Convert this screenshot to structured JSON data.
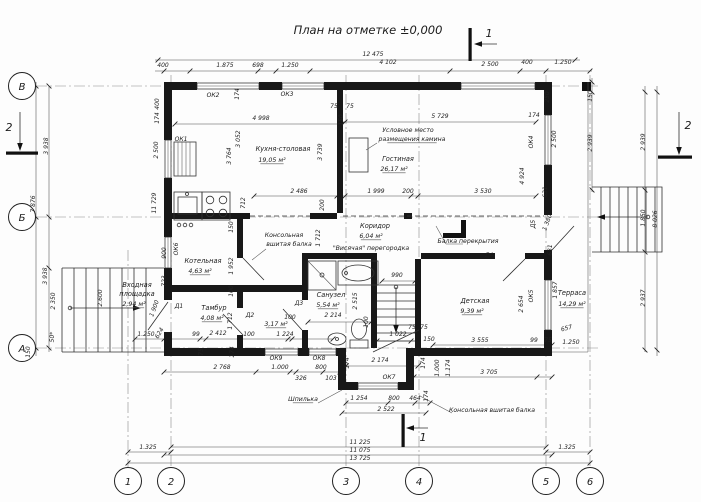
{
  "title": "План на отметке ±0,000",
  "axes": {
    "bottom": [
      {
        "label": "1",
        "x": 128
      },
      {
        "label": "2",
        "x": 171
      },
      {
        "label": "3",
        "x": 346
      },
      {
        "label": "4",
        "x": 419
      },
      {
        "label": "5",
        "x": 546
      },
      {
        "label": "6",
        "x": 590
      }
    ],
    "left": [
      {
        "label": "В",
        "y": 86
      },
      {
        "label": "Б",
        "y": 217
      },
      {
        "label": "А",
        "y": 348
      }
    ]
  },
  "section_markers": {
    "top": "1",
    "bottom": "1",
    "left": "2",
    "right": "2"
  },
  "rooms": [
    {
      "name": "Кухня-столовая",
      "area": "19,05 м²",
      "name_xy": [
        283,
        151
      ],
      "area_xy": [
        272,
        162
      ]
    },
    {
      "name": "Гостиная",
      "area": "26,17 м²",
      "name_xy": [
        398,
        161
      ],
      "area_xy": [
        394,
        171
      ]
    },
    {
      "name": "Коридор",
      "area": "6,04 м²",
      "name_xy": [
        375,
        228
      ],
      "area_xy": [
        371,
        238
      ]
    },
    {
      "name": "Санузел",
      "area": "5,54 м²",
      "name_xy": [
        331,
        297
      ],
      "area_xy": [
        328,
        307
      ]
    },
    {
      "name": "",
      "area": "3,17 м²",
      "name_xy": [
        276,
        318
      ],
      "area_xy": [
        276,
        326
      ]
    },
    {
      "name": "Котельная",
      "area": "4,63 м²",
      "name_xy": [
        203,
        263
      ],
      "area_xy": [
        200,
        273
      ]
    },
    {
      "name": "Тамбур",
      "area": "4,08 м²",
      "name_xy": [
        214,
        310
      ],
      "area_xy": [
        212,
        320
      ]
    },
    {
      "name": "Детская",
      "area": "9,39 м²",
      "name_xy": [
        475,
        303
      ],
      "area_xy": [
        472,
        313
      ]
    },
    {
      "name": "Терраса",
      "area": "14,29 м²",
      "name_xy": [
        572,
        295
      ],
      "area_xy": [
        572,
        306
      ]
    },
    {
      "name": "Входная площадка",
      "name_lines": [
        "Входная",
        "площадка"
      ],
      "area": "2,94 м²",
      "name_xy": [
        137,
        287
      ],
      "area_xy": [
        134,
        306
      ]
    }
  ],
  "annotations": [
    {
      "t": "Условное место",
      "x": 408,
      "y": 132
    },
    {
      "t": "размещения камина",
      "x": 412,
      "y": 141,
      "u": 1
    },
    {
      "t": "Балка перекрытия",
      "x": 468,
      "y": 243
    },
    {
      "t": "\"Висячая\" перегородка",
      "x": 371,
      "y": 250
    },
    {
      "t": "Консольная",
      "x": 284,
      "y": 237
    },
    {
      "t": "вшитая балка",
      "x": 289,
      "y": 246
    },
    {
      "t": "Консольная вшитая балка",
      "x": 492,
      "y": 412
    },
    {
      "t": "Шпилька",
      "x": 303,
      "y": 401,
      "u": 1
    }
  ],
  "window_marks": [
    {
      "t": "ОК1",
      "x": 181,
      "y": 141
    },
    {
      "t": "ОК2",
      "x": 213,
      "y": 97
    },
    {
      "t": "ОК3",
      "x": 287,
      "y": 96
    },
    {
      "t": "ОК4",
      "x": 533,
      "y": 142,
      "r": -90
    },
    {
      "t": "ОК5",
      "x": 533,
      "y": 296,
      "r": -90
    },
    {
      "t": "ОК6",
      "x": 178,
      "y": 249,
      "r": -90
    },
    {
      "t": "ОК7",
      "x": 389,
      "y": 379
    },
    {
      "t": "ОК8",
      "x": 319,
      "y": 360
    },
    {
      "t": "ОК9",
      "x": 276,
      "y": 360
    }
  ],
  "door_marks": [
    {
      "t": "Д1",
      "x": 179,
      "y": 308
    },
    {
      "t": "Д2",
      "x": 250,
      "y": 317
    },
    {
      "t": "Д3",
      "x": 299,
      "y": 305
    },
    {
      "t": "Д4",
      "x": 489,
      "y": 257
    },
    {
      "t": "Д5",
      "x": 535,
      "y": 224,
      "r": -90
    }
  ],
  "dimensions": [
    {
      "t": "12 475",
      "x": 373,
      "y": 56
    },
    {
      "t": "400",
      "x": 163,
      "y": 67
    },
    {
      "t": "1.875",
      "x": 225,
      "y": 67
    },
    {
      "t": "698",
      "x": 258,
      "y": 67
    },
    {
      "t": "1.250",
      "x": 290,
      "y": 67
    },
    {
      "t": "4 102",
      "x": 388,
      "y": 64
    },
    {
      "t": "2 500",
      "x": 490,
      "y": 66
    },
    {
      "t": "400",
      "x": 527,
      "y": 64
    },
    {
      "t": "1.250",
      "x": 563,
      "y": 64
    },
    {
      "t": "400",
      "x": 159,
      "y": 104,
      "r": -90
    },
    {
      "t": "174",
      "x": 159,
      "y": 118,
      "r": -90
    },
    {
      "t": "2 500",
      "x": 158,
      "y": 150,
      "r": -90
    },
    {
      "t": "11 729",
      "x": 156,
      "y": 203,
      "r": -90
    },
    {
      "t": "174",
      "x": 239,
      "y": 94,
      "r": -90
    },
    {
      "t": "4 998",
      "x": 261,
      "y": 120
    },
    {
      "t": "3 052",
      "x": 240,
      "y": 139,
      "r": -90
    },
    {
      "t": "3 764",
      "x": 231,
      "y": 156,
      "r": -90
    },
    {
      "t": "3 739",
      "x": 322,
      "y": 152,
      "r": -90
    },
    {
      "t": "2 486",
      "x": 299,
      "y": 193
    },
    {
      "t": "200",
      "x": 324,
      "y": 205,
      "r": -90
    },
    {
      "t": "712",
      "x": 245,
      "y": 203,
      "r": -90
    },
    {
      "t": "150",
      "x": 233,
      "y": 227,
      "r": -90
    },
    {
      "t": "75",
      "x": 334,
      "y": 108
    },
    {
      "t": "75",
      "x": 350,
      "y": 108
    },
    {
      "t": "150",
      "x": 343,
      "y": 120,
      "r": -90
    },
    {
      "t": "5 729",
      "x": 440,
      "y": 118
    },
    {
      "t": "174",
      "x": 534,
      "y": 117
    },
    {
      "t": "1 999",
      "x": 376,
      "y": 193
    },
    {
      "t": "200",
      "x": 408,
      "y": 193
    },
    {
      "t": "3 530",
      "x": 483,
      "y": 193
    },
    {
      "t": "4 924",
      "x": 524,
      "y": 176,
      "r": -90
    },
    {
      "t": "250",
      "x": 549,
      "y": 97,
      "r": -90
    },
    {
      "t": "2 500",
      "x": 556,
      "y": 139,
      "r": -90
    },
    {
      "t": "631",
      "x": 547,
      "y": 192,
      "r": -90
    },
    {
      "t": "150",
      "x": 592,
      "y": 96,
      "r": -90
    },
    {
      "t": "2 939",
      "x": 592,
      "y": 143,
      "r": -90
    },
    {
      "t": "2 939",
      "x": 645,
      "y": 142,
      "r": -90
    },
    {
      "t": "1.850",
      "x": 645,
      "y": 218,
      "r": -90
    },
    {
      "t": "2 937",
      "x": 645,
      "y": 298,
      "r": -90
    },
    {
      "t": "8 026",
      "x": 657,
      "y": 219,
      "r": -90
    },
    {
      "t": "1 380",
      "x": 549,
      "y": 223,
      "r": -70
    },
    {
      "t": "631",
      "x": 552,
      "y": 250,
      "r": -90
    },
    {
      "t": "2 654",
      "x": 523,
      "y": 304,
      "r": -90
    },
    {
      "t": "1 857",
      "x": 557,
      "y": 290,
      "r": -90
    },
    {
      "t": "657",
      "x": 567,
      "y": 330,
      "r": -15
    },
    {
      "t": "99",
      "x": 534,
      "y": 342
    },
    {
      "t": "75",
      "x": 548,
      "y": 342
    },
    {
      "t": "1.250",
      "x": 571,
      "y": 344
    },
    {
      "t": "3 938",
      "x": 48,
      "y": 146,
      "r": -90
    },
    {
      "t": "7 876",
      "x": 35,
      "y": 204,
      "r": -90
    },
    {
      "t": "3 938",
      "x": 47,
      "y": 276,
      "r": -90
    },
    {
      "t": "2 350",
      "x": 55,
      "y": 301,
      "r": -90
    },
    {
      "t": "2.600",
      "x": 102,
      "y": 298,
      "r": -90
    },
    {
      "t": "50*",
      "x": 54,
      "y": 337,
      "r": -90
    },
    {
      "t": "150",
      "x": 30,
      "y": 352,
      "r": -90
    },
    {
      "t": "900",
      "x": 166,
      "y": 253,
      "r": -90
    },
    {
      "t": "723",
      "x": 166,
      "y": 281,
      "r": -90
    },
    {
      "t": "1 900",
      "x": 156,
      "y": 309,
      "r": -70
    },
    {
      "t": "1 952",
      "x": 233,
      "y": 266,
      "r": -90
    },
    {
      "t": "100",
      "x": 233,
      "y": 291,
      "r": -90
    },
    {
      "t": "1 712",
      "x": 232,
      "y": 321,
      "r": -90
    },
    {
      "t": "1 712",
      "x": 320,
      "y": 238,
      "r": -90
    },
    {
      "t": "1.250",
      "x": 146,
      "y": 336
    },
    {
      "t": "624",
      "x": 161,
      "y": 334,
      "r": -60
    },
    {
      "t": "99",
      "x": 196,
      "y": 336
    },
    {
      "t": "2 412",
      "x": 218,
      "y": 335
    },
    {
      "t": "100",
      "x": 249,
      "y": 336
    },
    {
      "t": "1 224",
      "x": 285,
      "y": 336
    },
    {
      "t": "75",
      "x": 203,
      "y": 352,
      "r": -90
    },
    {
      "t": "174",
      "x": 234,
      "y": 352,
      "r": -90
    },
    {
      "t": "2 768",
      "x": 222,
      "y": 369
    },
    {
      "t": "1.000",
      "x": 280,
      "y": 369
    },
    {
      "t": "326",
      "x": 301,
      "y": 380
    },
    {
      "t": "800",
      "x": 321,
      "y": 369
    },
    {
      "t": "103",
      "x": 331,
      "y": 380
    },
    {
      "t": "174",
      "x": 349,
      "y": 363,
      "r": -90
    },
    {
      "t": "2 174",
      "x": 380,
      "y": 362
    },
    {
      "t": "174",
      "x": 425,
      "y": 363,
      "r": -90
    },
    {
      "t": "1 254",
      "x": 359,
      "y": 400
    },
    {
      "t": "800",
      "x": 394,
      "y": 400
    },
    {
      "t": "464",
      "x": 415,
      "y": 400
    },
    {
      "t": "2 522",
      "x": 386,
      "y": 411
    },
    {
      "t": "174",
      "x": 428,
      "y": 396,
      "r": -90
    },
    {
      "t": "990",
      "x": 397,
      "y": 277
    },
    {
      "t": "100",
      "x": 368,
      "y": 322,
      "r": -90
    },
    {
      "t": "2 515",
      "x": 357,
      "y": 301,
      "r": -90
    },
    {
      "t": "1 022",
      "x": 398,
      "y": 336
    },
    {
      "t": "75",
      "x": 412,
      "y": 329
    },
    {
      "t": "75",
      "x": 424,
      "y": 329
    },
    {
      "t": "150",
      "x": 429,
      "y": 341
    },
    {
      "t": "100",
      "x": 290,
      "y": 319
    },
    {
      "t": "2 214",
      "x": 333,
      "y": 317
    },
    {
      "t": "3 555",
      "x": 480,
      "y": 342
    },
    {
      "t": "3 705",
      "x": 489,
      "y": 374
    },
    {
      "t": "1.000",
      "x": 439,
      "y": 368,
      "r": -90
    },
    {
      "t": "1.174",
      "x": 450,
      "y": 368,
      "r": -90
    },
    {
      "t": "1.325",
      "x": 148,
      "y": 449
    },
    {
      "t": "11 225",
      "x": 360,
      "y": 444
    },
    {
      "t": "11 075",
      "x": 360,
      "y": 452
    },
    {
      "t": "13 725",
      "x": 360,
      "y": 460
    },
    {
      "t": "1.325",
      "x": 567,
      "y": 449
    }
  ]
}
